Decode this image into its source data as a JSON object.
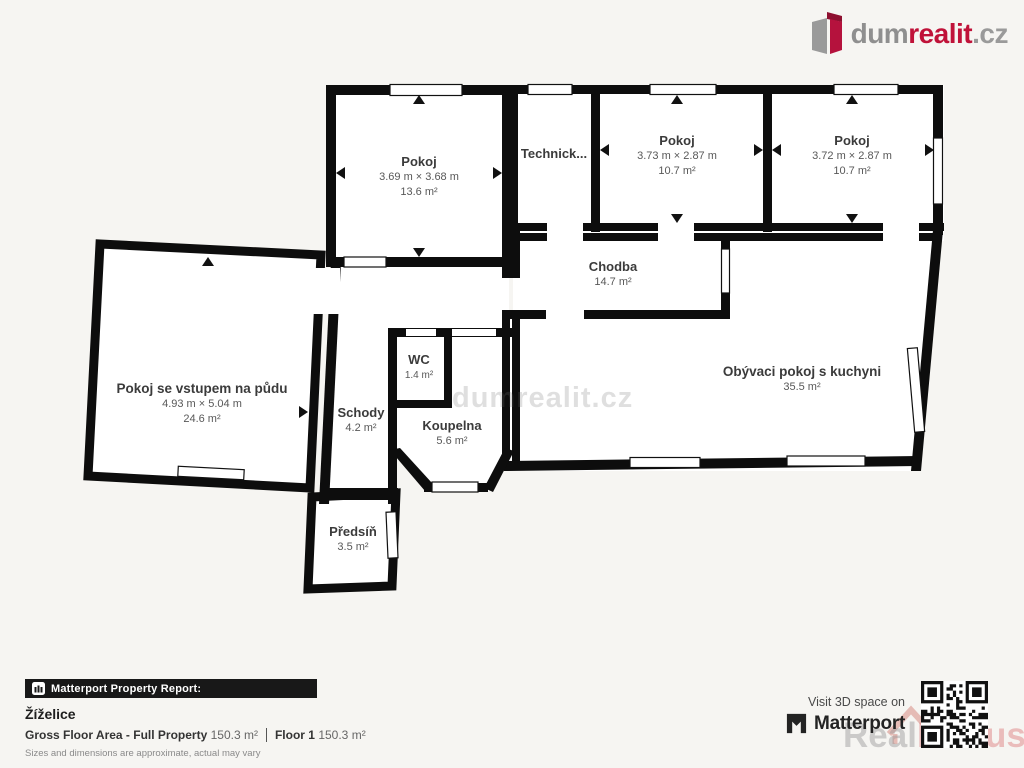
{
  "logo": {
    "prefix": "dum",
    "accent": "realit",
    "suffix": ".cz"
  },
  "plan_watermark": "dumrealit.cz",
  "rooms": {
    "pokoj_tl": {
      "name": "Pokoj",
      "dims": "3.69 m × 3.68 m",
      "area": "13.6 m²"
    },
    "technicka": {
      "name": "Technick..."
    },
    "pokoj_m": {
      "name": "Pokoj",
      "dims": "3.73 m × 2.87 m",
      "area": "10.7 m²"
    },
    "pokoj_r": {
      "name": "Pokoj",
      "dims": "3.72 m × 2.87 m",
      "area": "10.7 m²"
    },
    "chodba": {
      "name": "Chodba",
      "area": "14.7 m²"
    },
    "obyvaci": {
      "name": "Obývaci pokoj s kuchyni",
      "area": "35.5 m²"
    },
    "pudni": {
      "name": "Pokoj se vstupem na půdu",
      "dims": "4.93 m × 5.04 m",
      "area": "24.6 m²"
    },
    "schody": {
      "name": "Schody",
      "area": "4.2 m²"
    },
    "wc": {
      "name": "WC",
      "area": "1.4 m²"
    },
    "koupelna": {
      "name": "Koupelna",
      "area": "5.6 m²"
    },
    "predsin": {
      "name": "Předsíň",
      "area": "3.5 m²"
    }
  },
  "report": {
    "bar_label": "Matterport Property Report:",
    "title": "Žíželice",
    "gfa_label": "Gross Floor Area - Full Property",
    "gfa_value": "150.3 m²",
    "floor_label": "Floor 1",
    "floor_value": "150.3 m²",
    "disclaimer": "Sizes and dimensions are approximate, actual may vary"
  },
  "cta": {
    "visit": "Visit 3D space on",
    "brand": "Matterport"
  },
  "bottom_watermark": {
    "part1": "Real",
    "part2": "Bonus",
    "part3": ".cz"
  },
  "colors": {
    "wall": "#0d0d0d",
    "floor": "#ffffff",
    "background": "#f6f5f2",
    "brand_red": "#c01239"
  }
}
